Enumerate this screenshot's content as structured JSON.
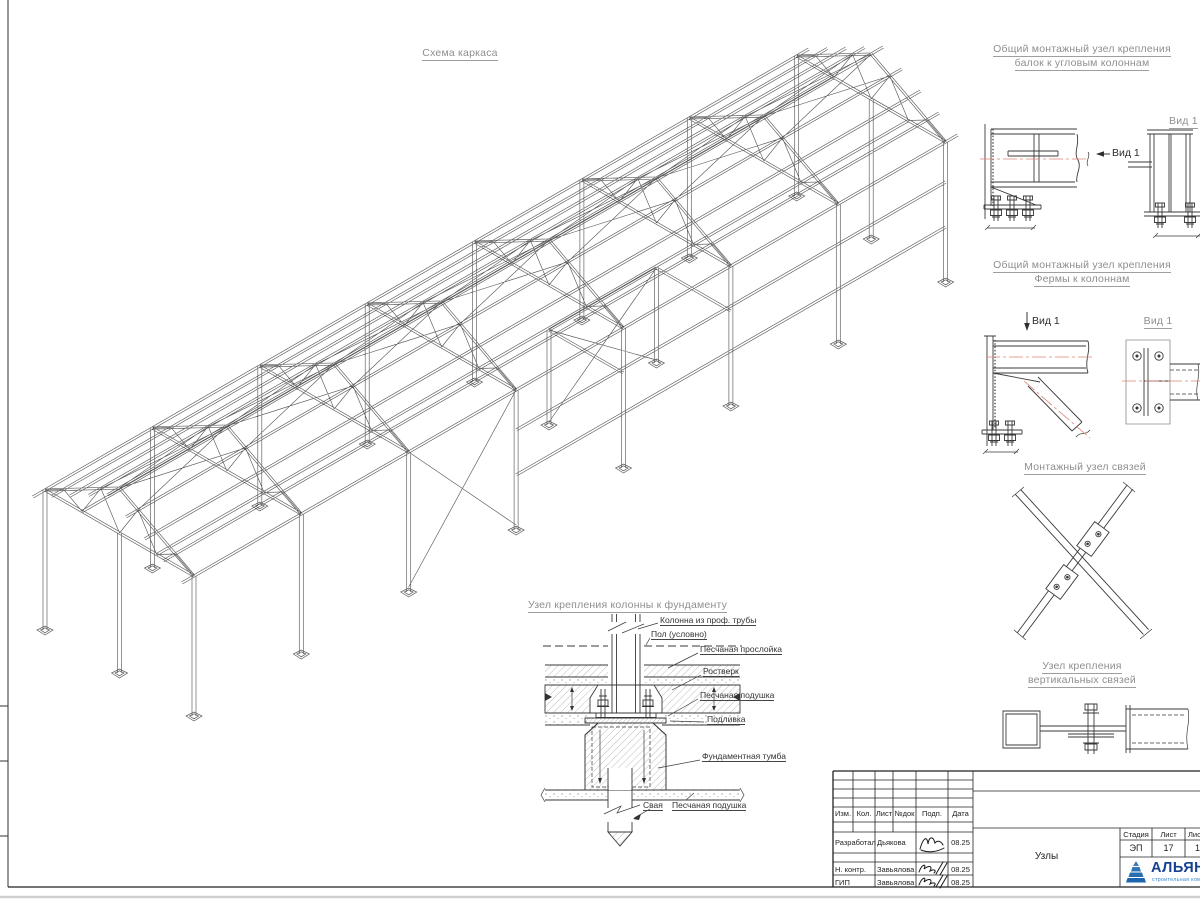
{
  "drawing": {
    "main_title": "Схема каркаса",
    "d1_title_1": "Общий монтажный узел крепления",
    "d1_title_2": "балок к угловым колоннам",
    "d2_title_1": "Общий монтажный узел крепления",
    "d2_title_2": "Фермы к колоннам",
    "d3_title": "Монтажный узел связей",
    "d4_title_1": "Узел крепления",
    "d4_title_2": "вертикальных связей",
    "foundation_title": "Узел крепления колонны к фундаменту",
    "view_labels": {
      "d1_arrow": "Вид 1",
      "d1_side": "Вид 1",
      "d2_arrow": "Вид 1",
      "d2_side": "Вид 1"
    },
    "foundation_labels": [
      "Колонна из проф. трубы",
      "Пол (условно)",
      "Песчаная прослойка",
      "Ростверк",
      "Песчаная подушка",
      "Подливка",
      "Фундаментная тумба",
      "Свая",
      "Песчаная подушка"
    ]
  },
  "title_block": {
    "header_cols": [
      "Изм.",
      "Кол.",
      "Лист",
      "№док",
      "Подп.",
      "Дата"
    ],
    "rows": [
      {
        "role": "Разработал",
        "name": "Дьякова",
        "date": "08.25"
      },
      {
        "role": "Н. контр.",
        "name": "Завьялова",
        "date": "08.25"
      },
      {
        "role": "ГИП",
        "name": "Завьялова",
        "date": "08.25"
      }
    ],
    "stage": {
      "label": "Стадия",
      "value": "ЭП"
    },
    "sheet": {
      "label": "Лист",
      "value": "17"
    },
    "sheets": {
      "label": "Лис",
      "value": "1"
    },
    "doc_name": "Узлы",
    "company": {
      "name": "АЛЬЯН",
      "subtitle": "строительная комп",
      "name_color": "#15418f",
      "subtitle_color": "#3c87cf",
      "logo_color": "#1d66ad"
    }
  }
}
